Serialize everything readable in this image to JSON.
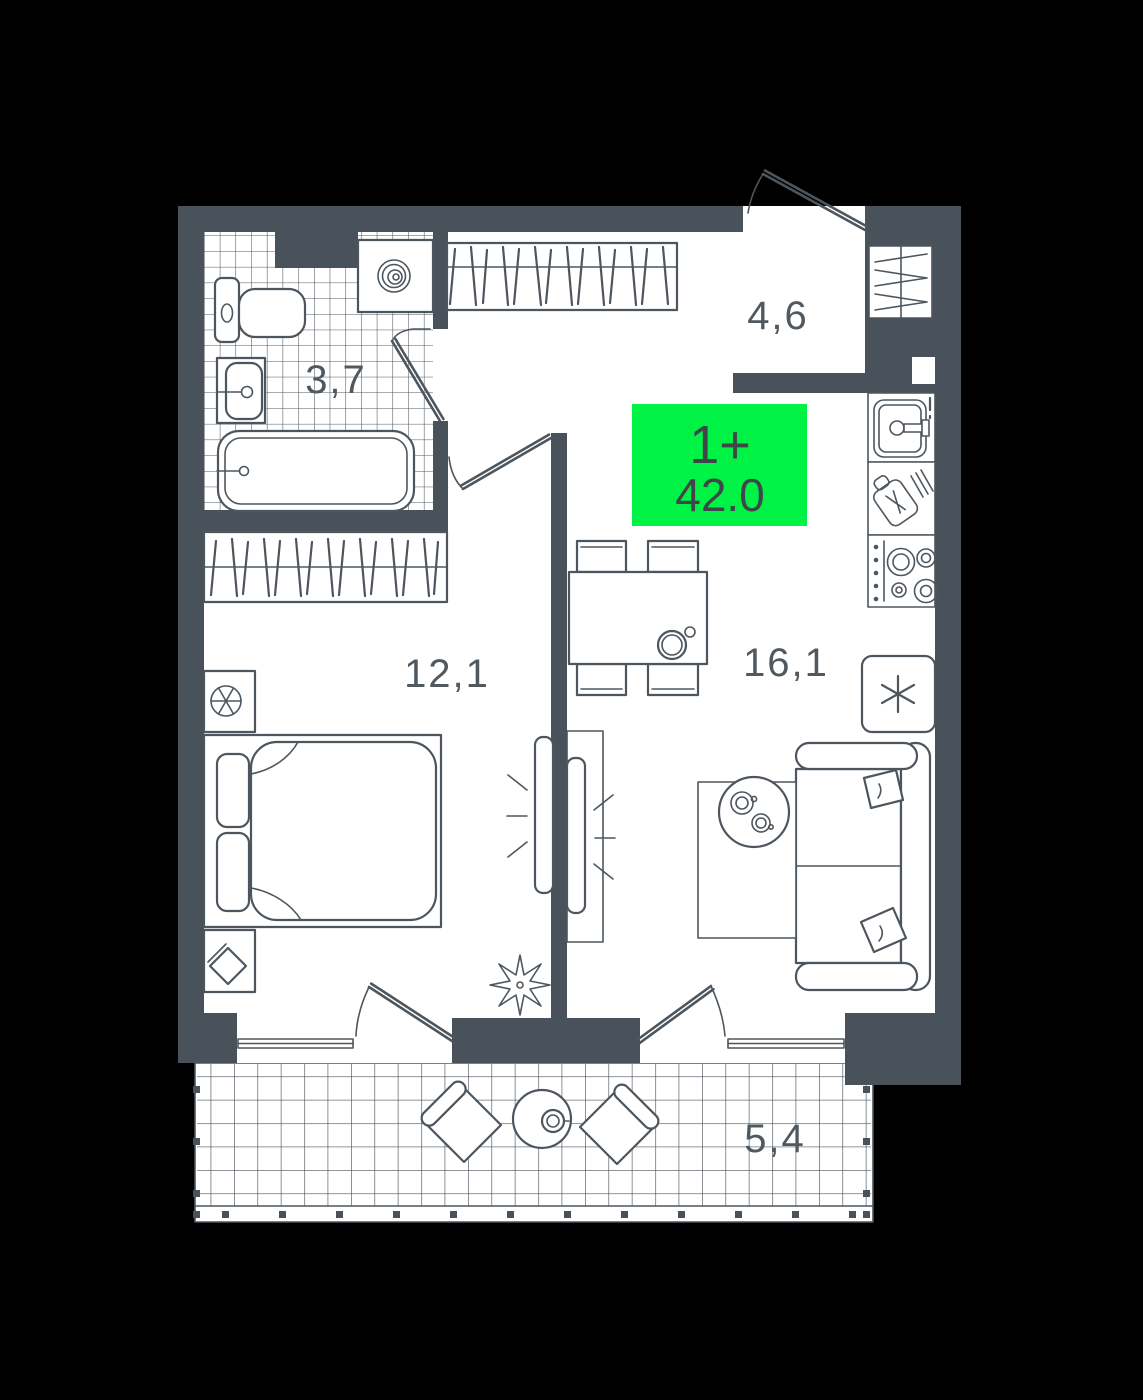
{
  "plan": {
    "unit_type": "1+",
    "total_area": "42.0",
    "rooms": [
      {
        "id": "bathroom",
        "area": "3,7"
      },
      {
        "id": "hallway",
        "area": "4,6"
      },
      {
        "id": "bedroom",
        "area": "12,1"
      },
      {
        "id": "living-kitchen",
        "area": "16,1"
      },
      {
        "id": "balcony",
        "area": "5,4"
      }
    ]
  },
  "colors": {
    "background": "#000000",
    "wall": "#49525A",
    "line": "#4D565E",
    "floor": "#FFFFFF",
    "accent": "#00F244",
    "badge_text": "#3E464C"
  }
}
